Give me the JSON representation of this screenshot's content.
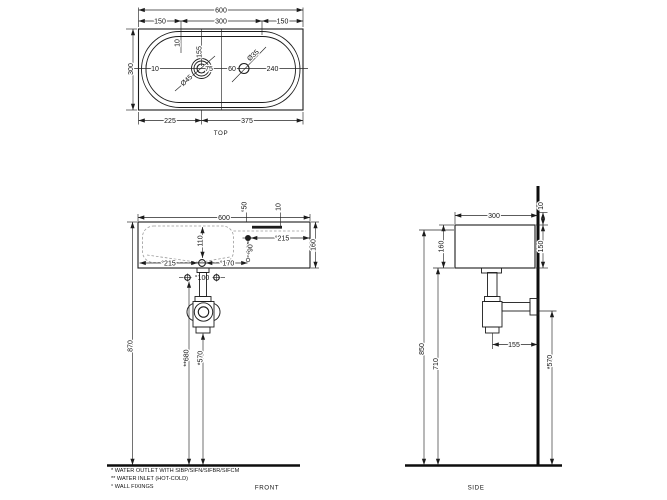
{
  "drawing": {
    "top": {
      "label": "TOP",
      "width": "600",
      "seg_left": "150",
      "seg_mid": "300",
      "seg_right": "150",
      "offset_rear": "10",
      "drain_to_rear": "155",
      "depth": "300",
      "rim": "10",
      "drain_dia": "Ø45",
      "d75": "75",
      "d60": "60",
      "tap_dia": "Ø35",
      "d240": "240",
      "drain_from_left": "225",
      "drain_to_right": "375"
    },
    "front": {
      "label": "FRONT",
      "width": "600",
      "fix_top": "°50",
      "d10": "10",
      "bowl_depth": "110",
      "fix_right": "°215",
      "fix_drop": "°90",
      "height": "160",
      "fix_left": "°215",
      "d170": "°170",
      "inlet_span": "°100",
      "h_total": "870",
      "h_inlet": "**680",
      "h_outlet": "*570"
    },
    "side": {
      "label": "SIDE",
      "depth": "300",
      "d10": "10",
      "h_fix": "150",
      "height": "160",
      "h_back": "850",
      "h_under": "710",
      "outlet_offset": "155",
      "h_outlet": "*570"
    },
    "footnotes": {
      "outlet": "* WATER OUTLET WITH SIBP/SIFN/SIFBR/SIFCM",
      "inlet": "** WATER INLET  (HOT-COLD)",
      "fixings": "° WALL FIXINGS"
    }
  }
}
